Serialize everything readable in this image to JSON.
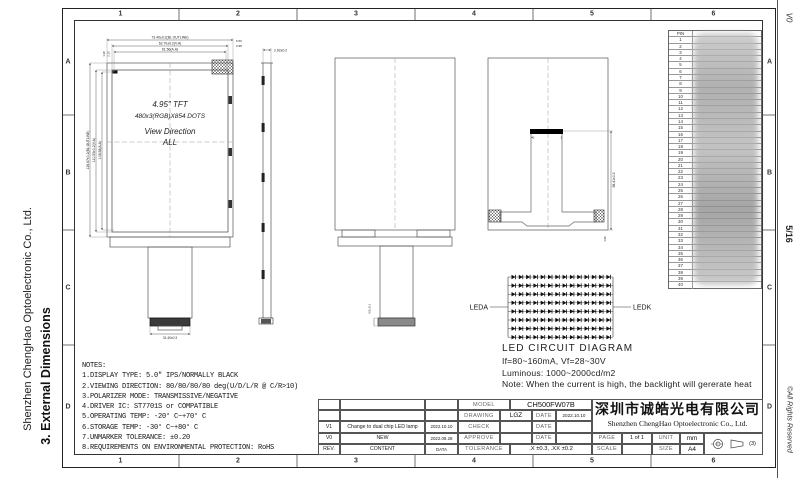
{
  "left_margin": {
    "company": "Shenzhen ChengHao Optoelectronic Co., Ltd.",
    "section": "3. External Dimensions"
  },
  "right_margin": {
    "revision": "V0",
    "page": "5/16",
    "copyright": "©All Rights Reserved"
  },
  "sheet_frame": {
    "columns": [
      "1",
      "2",
      "3",
      "4",
      "5",
      "6"
    ],
    "rows": [
      "A",
      "B",
      "C",
      "D"
    ]
  },
  "front_view": {
    "line1": "4.95\" TFT",
    "line2": "480x3(RGB)X854 DOTS",
    "line3": "View Direction",
    "line4": "ALL",
    "dim_outline_w": "73.40±0.2(BL OUTLINE)",
    "dim_va_w": "62.70±0.2(V.A)",
    "dim_aa_w": "61.56(A.A)",
    "dim_right_top": "6.50",
    "dim_right_sub": "0.98",
    "dim_left_a": "1.38",
    "dim_left_b": "2.15",
    "dim_outline_h": "126.67±0.2(BL OUTLINE)",
    "dim_va_h": "110.53±0.2(V.A)",
    "dim_aa_h": "108.58(A.A)",
    "dim_tail": "31.40±0.3"
  },
  "side_view": {
    "dim_thickness": "2.92±0.2"
  },
  "back_view_mid": {
    "dim_connector": "4.5±0.1"
  },
  "back_view_right": {
    "dim_fpc_length": "98.41±0.3",
    "dim_bottom": "1.80",
    "pin_40": "40",
    "pin_1": "1"
  },
  "led_diagram": {
    "label_anode": "LEDA",
    "label_cathode": "LEDK",
    "rows": 8,
    "cols": 14,
    "title": "LED CIRCUIT DIAGRAM",
    "spec_line1": "If=80~160mA, Vf=28~30V",
    "spec_line2": "Luminous: 1000~2000cd/m2",
    "note": "Note: When the current is high, the backlight will gererate heat"
  },
  "notes": {
    "title": "NOTES:",
    "items": [
      "1.DISPLAY TYPE:  5.0\" IPS/NORMALLY BLACK",
      "2.VIEWING DIRECTION: 80/80/80/80 deg(U/D/L/R @ C/R>10)",
      "3.POLARIZER MODE: TRANSMISSIVE/NEGATIVE",
      "4.DRIVER IC: ST7701S or COMPATIBLE",
      "5.OPERATING TEMP: -20° C~+70° C",
      "6.STORAGE TEMP: -30° C~+80° C",
      "7.UNMARKER TOLERANCE: ±0.20",
      "8.REQUIREMENTS ON ENVIRONMENTAL PROTECTION: RoHS"
    ]
  },
  "pin_table": {
    "header": "PIN",
    "pin_count": 40
  },
  "revision_table": {
    "rows": [
      [
        "",
        "",
        ""
      ],
      [
        "",
        "",
        ""
      ],
      [
        "V1",
        "Change to dual chip LED lamp",
        "2022.10.10"
      ],
      [
        "V0",
        "NEW",
        "2022.09.28"
      ],
      [
        "REV.",
        "CONTENT",
        "DATA"
      ]
    ]
  },
  "title_block": {
    "model_label": "MODEL",
    "model": "CH500FW07B",
    "drawing_label": "DRAWING",
    "drawing": "LGZ",
    "date_label": "DATE",
    "drawing_date": "2022.10.10",
    "check_label": "CHECK",
    "approve_label": "APPROVE",
    "tolerance_label": "TOLERANCE",
    "tolerance": ".X ±0.3,  .XX ±0.2",
    "company_cn": "深圳市诚皓光电有限公司",
    "company_en": "Shenzhen ChengHao Optoelectronic Co., Ltd.",
    "page_label": "PAGE",
    "page": "1 of 1",
    "unit_label": "UNIT",
    "unit": "mm",
    "scale_label": "SCALE",
    "scale": "",
    "size_label": "SIZE",
    "size": "A4",
    "projection": "(3)"
  }
}
